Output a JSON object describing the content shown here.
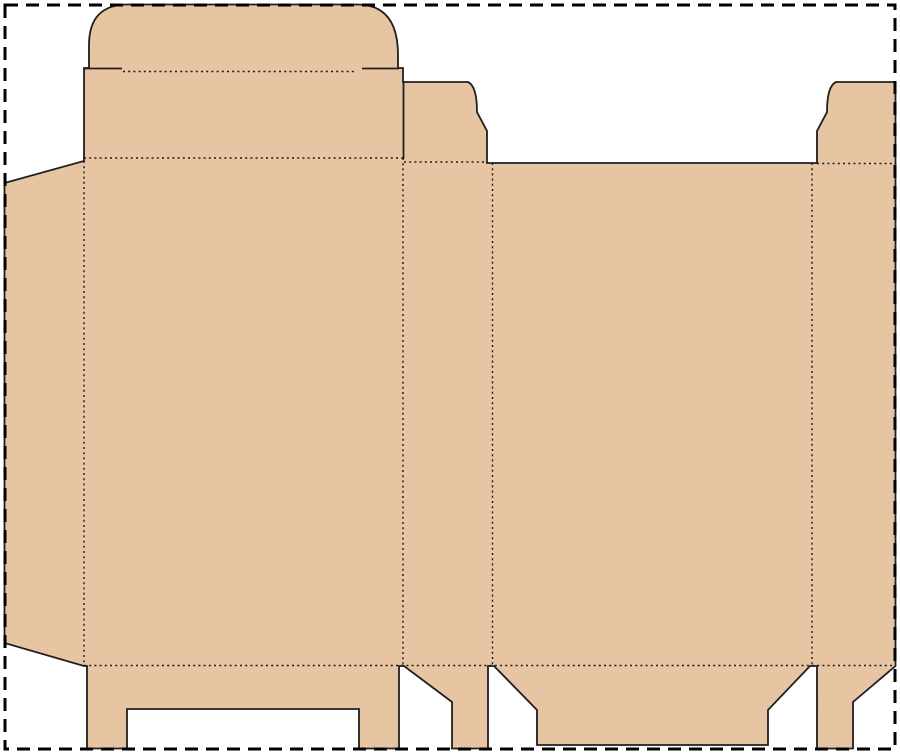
{
  "page": {
    "title": "folding-carton-dieline-template",
    "width": 900,
    "height": 753,
    "background": "#ffffff"
  },
  "colors": {
    "board_fill": "#e7c4a2",
    "cut_stroke": "#1f1f1f",
    "fold_stroke": "#1b1b1b",
    "border_stroke": "#000000"
  },
  "page_border": {
    "name": "artboard-dashed-border",
    "x": 5,
    "y": 5,
    "width": 890,
    "height": 744,
    "stroke_width": 3,
    "dash": "13 8"
  },
  "dieline": {
    "outline": {
      "name": "dieline-outline",
      "path": "M4.5 183 L84 161 L84 68 L89 68 L89 45 Q89 4.5 128 4.5 L357 4.5 Q398 4.5 398 55 L398 68 L403 68 L403 82 L468 82 Q477 86 477 112 L487 131 L487 163 L816 163 L817 163 L817 131 L827 112 Q827 86 836 82 L895.5 82 L895.5 666 L853 702 L853 748.5 L817 748.5 L817 666 L810 666 L768 710 L768 745 L537 745 L537 710 L494 666 L488 666 L488 748.5 L452 748.5 L452 702 L404 666 L399 666 L399 748.5 L359 748.5 L359 709 L127 709 L127 748.5 L87 748.5 L87 666 L84 666 L4.5 643 Z",
      "stroke_width": 1.8
    },
    "cut_lines": [
      {
        "name": "cut-shoulder-left",
        "x1": 84,
        "y1": 68.5,
        "x2": 122,
        "y2": 68.5
      },
      {
        "name": "cut-shoulder-right",
        "x1": 362,
        "y1": 68.5,
        "x2": 399,
        "y2": 68.5
      },
      {
        "name": "cut-lid-dustflap-slit",
        "x1": 403.5,
        "y1": 82,
        "x2": 403.5,
        "y2": 159
      }
    ],
    "cut_stroke_width": 1.8,
    "fold_lines": [
      {
        "name": "fold-tuck-flap",
        "x1": 123,
        "y1": 71.5,
        "x2": 357,
        "y2": 71.5
      },
      {
        "name": "fold-lid-top",
        "x1": 84,
        "y1": 158,
        "x2": 403,
        "y2": 158
      },
      {
        "name": "fold-dust-flap-left",
        "x1": 404,
        "y1": 162,
        "x2": 487,
        "y2": 162
      },
      {
        "name": "fold-dust-flap-right",
        "x1": 817,
        "y1": 163.5,
        "x2": 895,
        "y2": 163.5
      },
      {
        "name": "fold-bottom",
        "x1": 84,
        "y1": 665.5,
        "x2": 895,
        "y2": 665.5
      },
      {
        "name": "fold-glue-flap",
        "x1": 84,
        "y1": 161,
        "x2": 84,
        "y2": 665.5
      },
      {
        "name": "fold-panel-a-b",
        "x1": 403,
        "y1": 158,
        "x2": 403,
        "y2": 665.5
      },
      {
        "name": "fold-panel-b-c",
        "x1": 492.5,
        "y1": 163,
        "x2": 492.5,
        "y2": 665.5
      },
      {
        "name": "fold-panel-c-d",
        "x1": 812,
        "y1": 163,
        "x2": 812,
        "y2": 665.5
      }
    ],
    "fold_stroke_width": 1.4,
    "fold_dash": "2 3.2"
  }
}
